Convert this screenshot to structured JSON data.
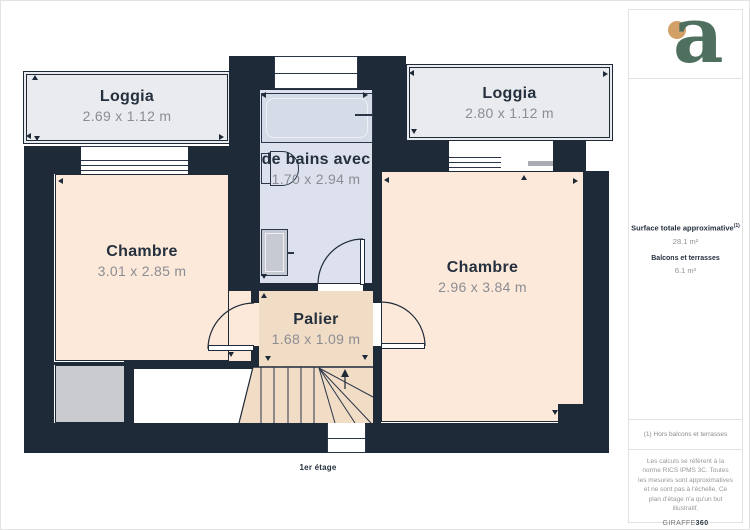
{
  "page": {
    "floor_label": "1er étage"
  },
  "plan": {
    "rooms": {
      "loggia_left": {
        "name": "Loggia",
        "dims": "2.69 x 1.12 m"
      },
      "loggia_right": {
        "name": "Loggia",
        "dims": "2.80 x 1.12 m"
      },
      "bathroom": {
        "name": "de bains avec",
        "dims": "1.70 x 2.94 m"
      },
      "chambre_left": {
        "name": "Chambre",
        "dims": "3.01 x 2.85 m"
      },
      "chambre_right": {
        "name": "Chambre",
        "dims": "2.96 x 3.84 m"
      },
      "palier": {
        "name": "Palier",
        "dims": "1.68 x 1.09 m"
      }
    },
    "colors": {
      "wall": "#1f2a38",
      "room_peach": "#fce9d9",
      "landing_tan": "#f1dcc6",
      "bathroom_blue": "#dce1ed",
      "loggia_gray": "#e9ebee",
      "closet_gray": "#c9cbce"
    }
  },
  "sidebar": {
    "logo_letter": "a",
    "surface_title": "Surface totale approximative",
    "surface_sup": "(1)",
    "surface_value": "28.1 m²",
    "balcony_title": "Balcons et terrasses",
    "balcony_value": "6.1 m²",
    "footnote": "(1) Hors balcons et terrasses",
    "legal": "Les calculs se réfèrent à la norme RICS IPMS 3C. Toutes les mesures sont approximatives et ne sont pas à l'échelle. Ce plan d'étage n'a qu'un but illustratif.",
    "brand_prefix": "GIRAFFE",
    "brand_suffix": "360"
  }
}
